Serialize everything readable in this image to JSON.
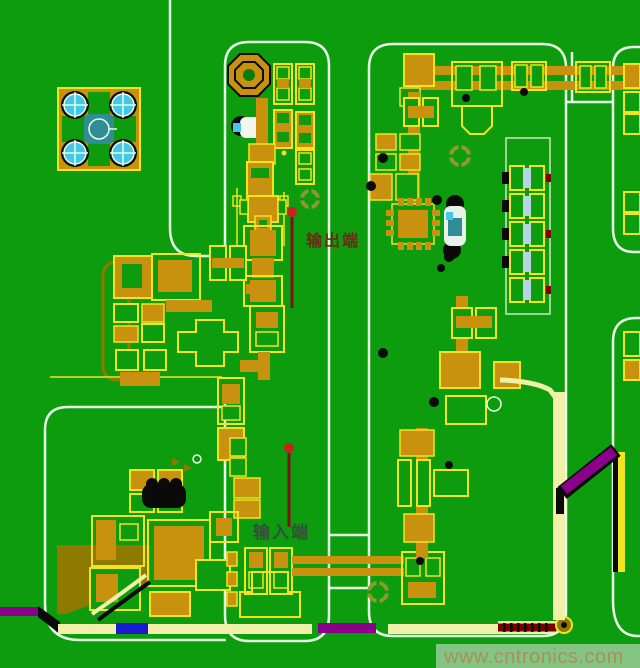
{
  "app": {
    "type": "pcb-layout-screenshot",
    "description": "RF PCB copper layout with shielded compartments"
  },
  "labels": {
    "output_port": "输出端",
    "input_port": "输入端"
  },
  "watermark": {
    "text": "www.cntronics.com"
  },
  "palette": {
    "green": "#0D9C0D",
    "green_dark": "#0A7C0A",
    "orange": "#C8920E",
    "yellow": "#F2E41E",
    "pale": "#F0F0A8",
    "olive": "#8F7A00",
    "white_line": "#E6FFE6",
    "cyan": "#45C8E8",
    "teal": "#2F8D96",
    "magenta": "#8B008B",
    "blue": "#1A1AD0",
    "maroon": "#7A0000",
    "black": "#0A0A0A",
    "slot_blue": "#B8D4E4",
    "fiducial": "#8A9A30",
    "red_dot": "#CC2020",
    "red_line": "#7A1515",
    "label_red": "#7A1818",
    "label_gray": "#3A4540",
    "wm_band": "#9ACD9A",
    "wm_text": "#A5915A"
  },
  "board": {
    "regions": [
      {
        "name": "top-left-shield"
      },
      {
        "name": "middle-column-shield"
      },
      {
        "name": "bottom-left-shield"
      },
      {
        "name": "right-main-shield"
      },
      {
        "name": "far-right-shield-upper"
      },
      {
        "name": "far-right-shield-lower"
      }
    ],
    "notable_parts": [
      {
        "name": "mounting-pad-4hole"
      },
      {
        "name": "octagon-pad"
      },
      {
        "name": "qfn-ic"
      },
      {
        "name": "slotted-connector"
      },
      {
        "name": "inductor-black"
      },
      {
        "name": "blue-trace-segment"
      },
      {
        "name": "red-hatched-trace"
      },
      {
        "name": "magenta-traces"
      }
    ]
  }
}
